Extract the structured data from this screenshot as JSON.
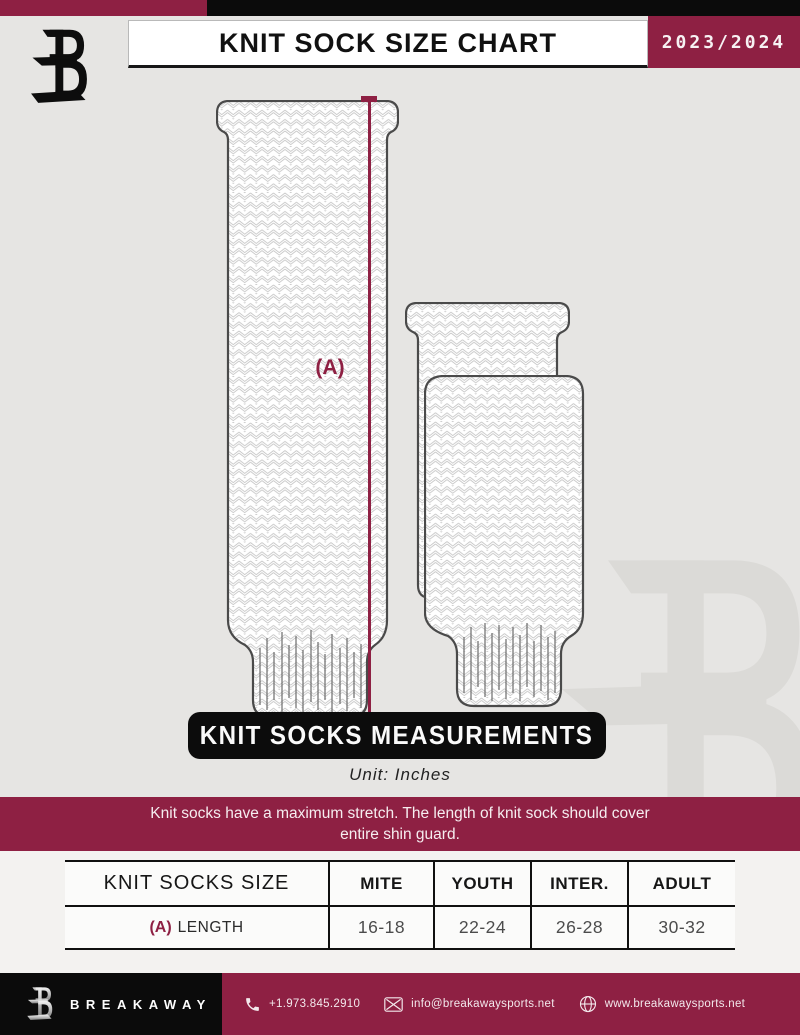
{
  "header": {
    "title": "KNIT SOCK SIZE CHART",
    "season": "2023/2024",
    "brand_logo": "breakaway-b-logo"
  },
  "diagram": {
    "measurement_label": "(A)"
  },
  "measurements_banner": {
    "title": "KNIT SOCKS MEASUREMENTS",
    "unit": "Unit: Inches"
  },
  "note": {
    "line1": "Knit socks have a maximum stretch. The length of knit sock should cover",
    "line2": "entire shin guard."
  },
  "size_table": {
    "columns": [
      "KNIT SOCKS SIZE",
      "MITE",
      "YOUTH",
      "INTER.",
      "ADULT"
    ],
    "rows": [
      {
        "key": "(A)",
        "label": "LENGTH",
        "values": [
          "16-18",
          "22-24",
          "26-28",
          "30-32"
        ]
      }
    ]
  },
  "footer": {
    "brand": "BREAKAWAY",
    "phone": "+1.973.845.2910",
    "email": "info@breakawaysports.net",
    "website": "www.breakawaysports.net",
    "icons": [
      "phone-icon",
      "mail-icon",
      "globe-icon"
    ]
  },
  "colors": {
    "maroon": "#8e2043",
    "black": "#0c0c0c",
    "background": "#e6e5e3",
    "light_section": "#f3f2f0"
  },
  "chart_data": {
    "type": "table",
    "title": "KNIT SOCK SIZE CHART",
    "unit": "Inches",
    "categories": [
      "MITE",
      "YOUTH",
      "INTER.",
      "ADULT"
    ],
    "series": [
      {
        "name": "(A) LENGTH",
        "values": [
          "16-18",
          "22-24",
          "26-28",
          "30-32"
        ]
      }
    ]
  }
}
